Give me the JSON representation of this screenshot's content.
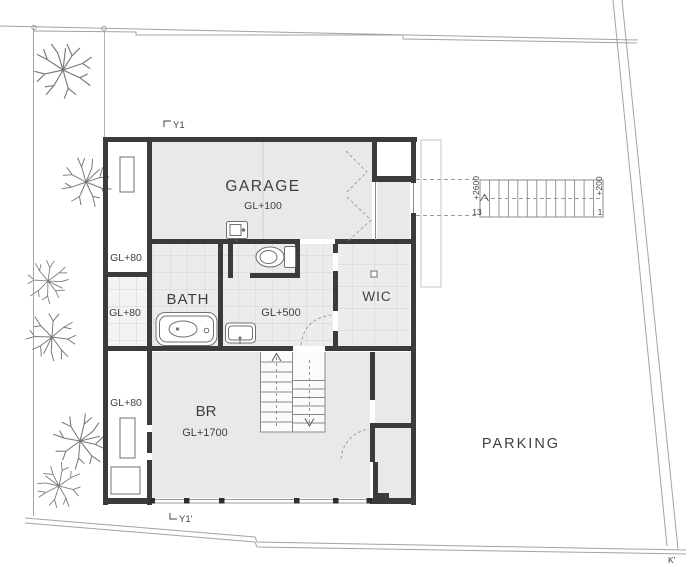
{
  "plan": {
    "garage_label": "GARAGE",
    "garage_level": "GL+100",
    "bath_label": "BATH",
    "hall_level": "GL+500",
    "wic_label": "WIC",
    "br_label": "BR",
    "br_level": "GL+1700",
    "parking_label": "PARKING",
    "terrace_top_level": "GL+80",
    "terrace_mid_level": "GL+80",
    "terrace_bottom_level": "GL+80",
    "grid_mark_top": "Y1",
    "grid_mark_bottom": "Y1'",
    "boundary_mark": "K'",
    "exterior_stair": {
      "upper_level": "+2600",
      "upper_step": "13",
      "lower_level": "+200",
      "lower_step": "1"
    },
    "colors": {
      "wall": "#3b3b3b",
      "room_fill": "#e9e9e9",
      "tile_line": "#c9c9c9",
      "thin_line": "#8a8a8a",
      "boundary_line": "#a3a3a3",
      "dashed_line": "#999999",
      "text": "#3f3f3f"
    }
  }
}
